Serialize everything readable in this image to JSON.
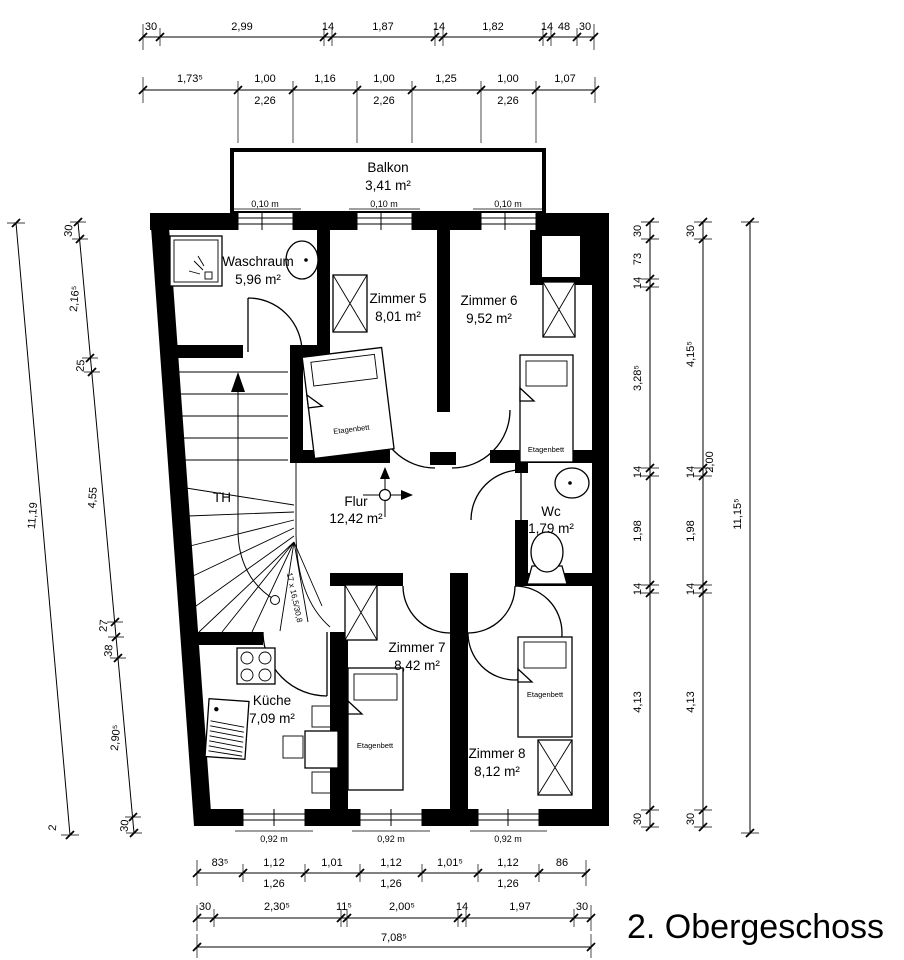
{
  "title": "2. Obergeschoss",
  "rooms": [
    {
      "name": "Balkon",
      "area": "3,41 m²"
    },
    {
      "name": "Waschraum",
      "area": "5,96 m²"
    },
    {
      "name": "Zimmer 5",
      "area": "8,01 m²"
    },
    {
      "name": "Zimmer 6",
      "area": "9,52 m²"
    },
    {
      "name": "Flur",
      "area": "12,42 m²"
    },
    {
      "name": "Wc",
      "area": "1,79 m²"
    },
    {
      "name": "Küche",
      "area": "7,09 m²"
    },
    {
      "name": "Zimmer 7",
      "area": "8,42 m²"
    },
    {
      "name": "Zimmer 8",
      "area": "8,12 m²"
    }
  ],
  "labels": {
    "stair": "TH",
    "stair_note": "17 x 16,5/30,8",
    "bed": "Etagenbett"
  },
  "windows": {
    "top": [
      "0,10 m",
      "0,10 m",
      "0,10 m"
    ],
    "bottom": [
      "0,92 m",
      "0,92 m",
      "0,92 m"
    ]
  },
  "dims": {
    "top1": [
      "30",
      "2,99",
      "14",
      "1,87",
      "14",
      "1,82",
      "14",
      "48",
      "30"
    ],
    "top2": [
      "1,73⁵",
      "1,00",
      "1,16",
      "1,00",
      "1,25",
      "1,00",
      "1,07"
    ],
    "top2_sub": [
      "2,26",
      "2,26",
      "2,26"
    ],
    "left_outer": {
      "total": "11,19",
      "end": "2"
    },
    "left_inner": [
      "30",
      "2,16⁵",
      "25",
      "4,55",
      "27",
      "38",
      "2,90⁵",
      "30"
    ],
    "right_inner": [
      "30",
      "73",
      "14",
      "3,28⁵",
      "14",
      "1,98",
      "14",
      "4,13",
      "30"
    ],
    "right_mid": [
      "30",
      "4,15⁵",
      "14",
      "1,98",
      "14",
      "4,13",
      "30"
    ],
    "right_mid_extra": "2,00",
    "right_outer": "11,15⁵",
    "bottom1": [
      "83⁵",
      "1,12",
      "1,01",
      "1,12",
      "1,01⁵",
      "1,12",
      "86"
    ],
    "bottom1_sub": [
      "1,26",
      "1,26",
      "1,26"
    ],
    "bottom2": [
      "30",
      "2,30⁵",
      "11⁵",
      "2,00⁵",
      "14",
      "1,97",
      "30"
    ],
    "bottom3": "7,08⁵"
  }
}
